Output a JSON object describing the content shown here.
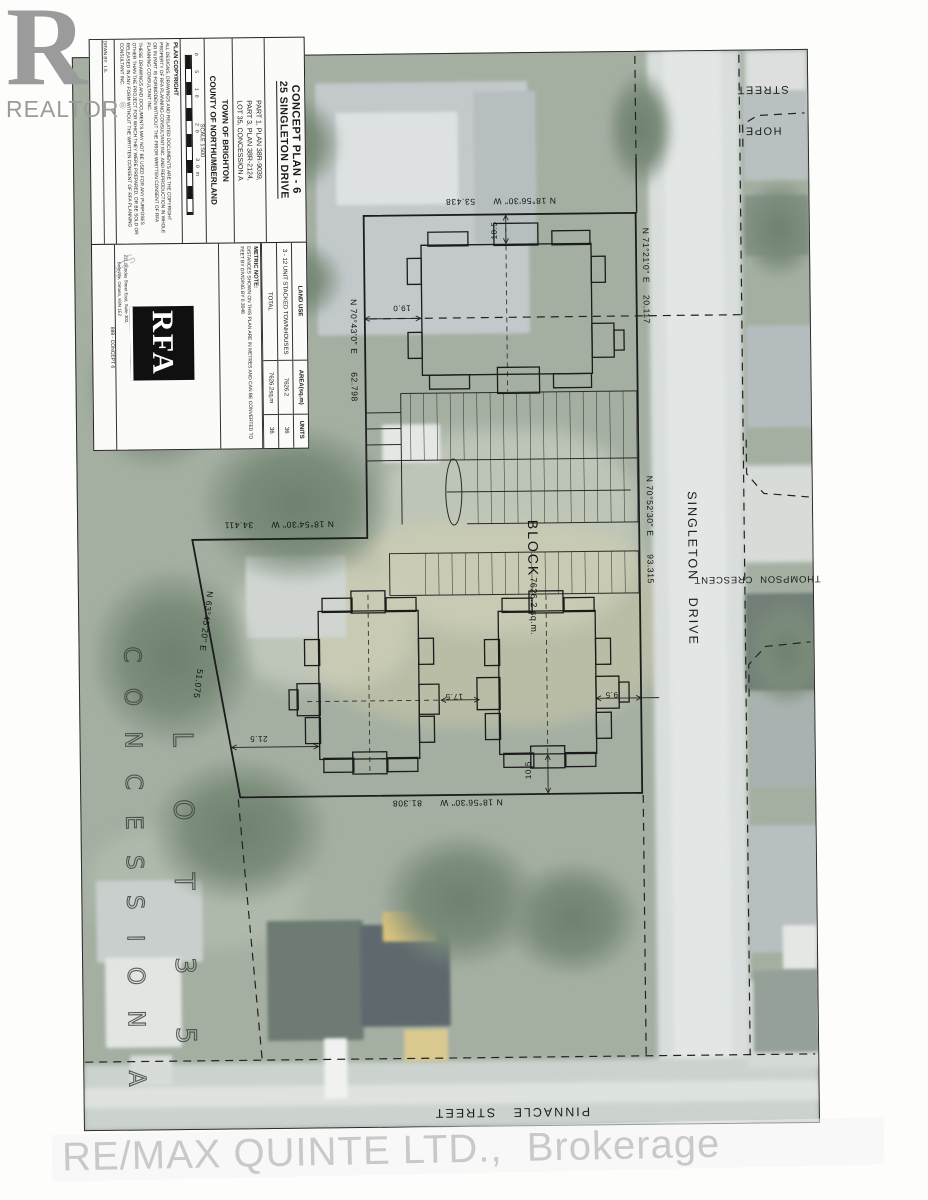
{
  "branding": {
    "realtor_r": "R",
    "realtor_word": "REALTOR",
    "registered_mark": "®",
    "remax_watermark": "RE/MAX QUINTE LTD.,  Brokerage"
  },
  "title_block": {
    "title_line1": "CONCEPT PLAN - 6",
    "title_line2": "25 SINGLETON DRIVE",
    "part_line1": "PART 1, PLAN 38R-9039,",
    "part_line2": "PART 3, PLAN 38R-2124,",
    "part_line3": "LOT 35, CONCESSION A",
    "municipality": "TOWN OF BRIGHTON",
    "county": "COUNTY OF NORTHUMBERLAND",
    "scale_label": "SCALE 1:500",
    "scale_ticks": "0  5  10    20    30m",
    "copyright_heading": "PLAN COPYRIGHT",
    "copyright_para1": "ALL DESIGNS, DRAWINGS AND RELATED DOCUMENTS ARE THE COPYRIGHT PROPERTY OF RFA PLANNING CONSULTANT INC. AND REPRODUCTION IN WHOLE OR IN PART IS FORBIDDEN WITHOUT THE PRIOR WRITTEN CONSENT OF RFA PLANNING CONSULTANT INC.",
    "copyright_para2": "THESE DRAWINGS AND DOCUMENTS MAY NOT BE USED FOR ANY PURPOSES OTHER THAN THE PROJECT FOR WHICH THEY WERE PREPARED, OR BE SOLD OR RELEASED IN ANY FORM WITHOUT THE WRITTEN CONSENT OF RFA PLANNING CONSULTANT INC.",
    "info_row1": "DRWN BY:  I.S.",
    "info_row2": "CHKD BY:  T.A.",
    "info_row3": "DATE:  SEPT. 27, 2021",
    "info_row4": "SCALE:  1:500",
    "job_label": "899 - CONCEPT 6",
    "date_watermark": "SEPTEMBER 27, 2021",
    "land_use": {
      "header_name": "LAND USE",
      "header_area": "AREA(sq.m)",
      "header_units": "UNITS",
      "row1_name": "3 - 12 UNIT STACKED TOWNHOUSES",
      "row1_area": "7626.2",
      "row1_units": "36",
      "row2_name": "TOTAL",
      "row2_area": "7626.2sq.m",
      "row2_units": "36"
    },
    "metric_heading": "METRIC NOTE:",
    "metric_body": "DISTANCES SHOWN ON THIS PLAN ARE IN METRES AND CAN BE CONVERTED TO FEET BY DIVIDING BY 0.3048",
    "firm_logo": "RFA",
    "firm_address_line1": "231 Dundas Street East, Suite 302,",
    "firm_address_line2": "Belleville, Ontario, K8N 1E2"
  },
  "plan": {
    "block_name": "BLOCK",
    "block_area": "7626.2 sq.m.",
    "streets": {
      "singleton": "SINGLETON   DRIVE",
      "hope_line1": "HOPE",
      "hope_line2": "STREET",
      "thompson": "THOMPSON  CRESCENT",
      "pinnacle": "PINNACLE   STREET"
    },
    "lot": {
      "lot_word": "L O T",
      "lot_number": "3 5",
      "concession_word": "C O N C E S S I O N",
      "concession_letter": "A"
    },
    "bearings": {
      "north": "N 18°56'30\" W      53.438",
      "east_upper": "N 71°21'0\" E    20.117",
      "west": "N 70°43'0\" E      62.798",
      "east": "N 70°52'30\" E      93.315",
      "west_step": "N 18°54'30\" W      34.411",
      "southwest": "N 63°45'20\" E      51.075",
      "south": "N 18°56'30\" W      81.308"
    },
    "dims": {
      "north_setback": "10.5",
      "west_setback": "19.0",
      "sw_setback": "21.5",
      "between": "17.5",
      "east_setback": "9.5",
      "south_setback": "10.5"
    }
  }
}
